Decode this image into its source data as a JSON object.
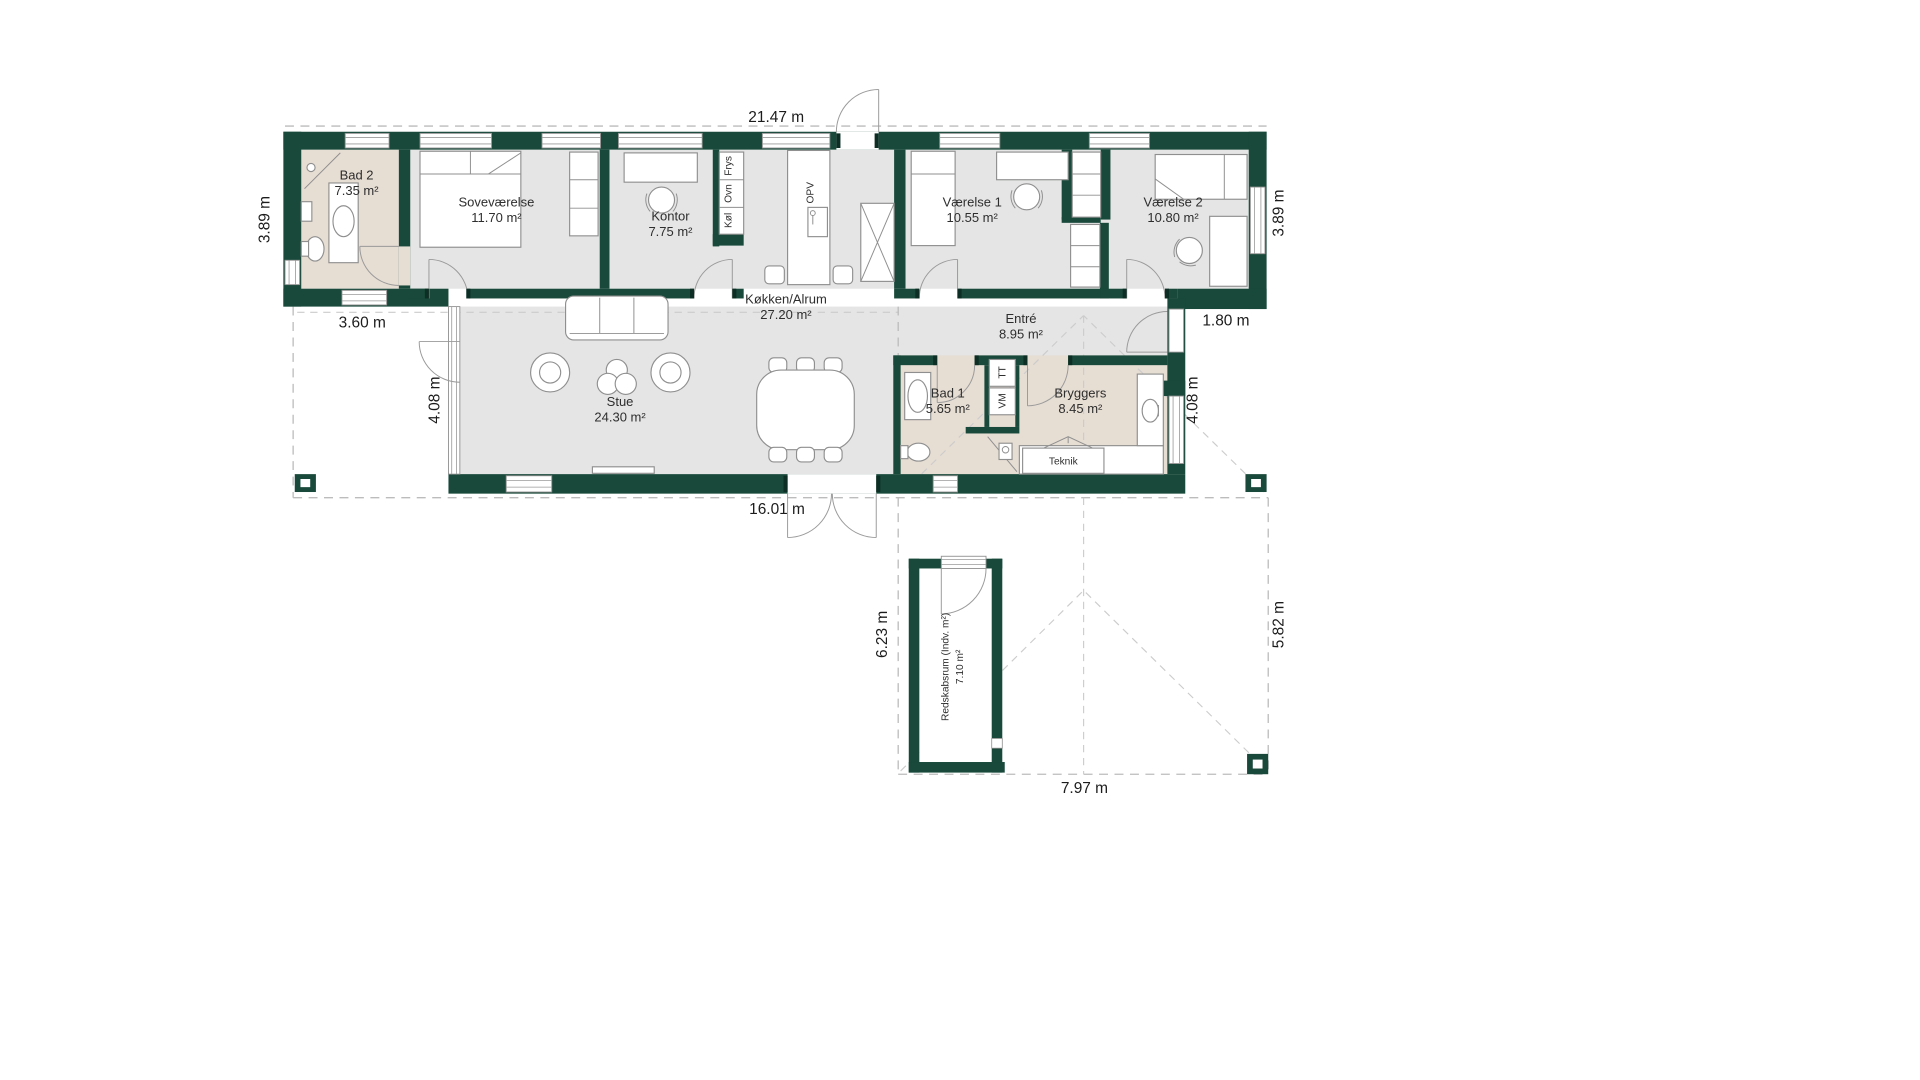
{
  "title": "Floor plan",
  "rooms": {
    "bad2": {
      "name": "Bad 2",
      "area": "7.35 m²"
    },
    "sovevaerelse": {
      "name": "Soveværelse",
      "area": "11.70 m²"
    },
    "kontor": {
      "name": "Kontor",
      "area": "7.75 m²"
    },
    "koekken": {
      "name": "Køkken/Alrum",
      "area": "27.20 m²"
    },
    "vaerelse1": {
      "name": "Værelse 1",
      "area": "10.55 m²"
    },
    "vaerelse2": {
      "name": "Værelse 2",
      "area": "10.80 m²"
    },
    "stue": {
      "name": "Stue",
      "area": "24.30 m²"
    },
    "entre": {
      "name": "Entré",
      "area": "8.95 m²"
    },
    "bad1": {
      "name": "Bad 1",
      "area": "5.65 m²"
    },
    "bryggers": {
      "name": "Bryggers",
      "area": "8.45 m²"
    },
    "teknik": {
      "name": "Teknik"
    },
    "redskabsrum": {
      "name": "Redskabsrum (Indv. m²)",
      "area": "7.10 m²"
    }
  },
  "appliances": {
    "frys": "Frys",
    "ovn": "Ovn",
    "koel": "Køl",
    "opv": "OPV",
    "tt": "TT",
    "vm": "VM"
  },
  "dimensions": {
    "top": "21.47 m",
    "left_upper": "3.89 m",
    "right_upper": "3.89 m",
    "left_section": "3.60 m",
    "right_section": "1.80 m",
    "left_lower": "4.08 m",
    "right_lower": "4.08 m",
    "bottom": "16.01 m",
    "carport_left": "6.23 m",
    "carport_right": "5.82 m",
    "carport_bottom": "7.97 m"
  },
  "colors": {
    "wall": "#18493a",
    "floor_gray": "#e4e5e4",
    "floor_beige": "#e6ddd3"
  }
}
